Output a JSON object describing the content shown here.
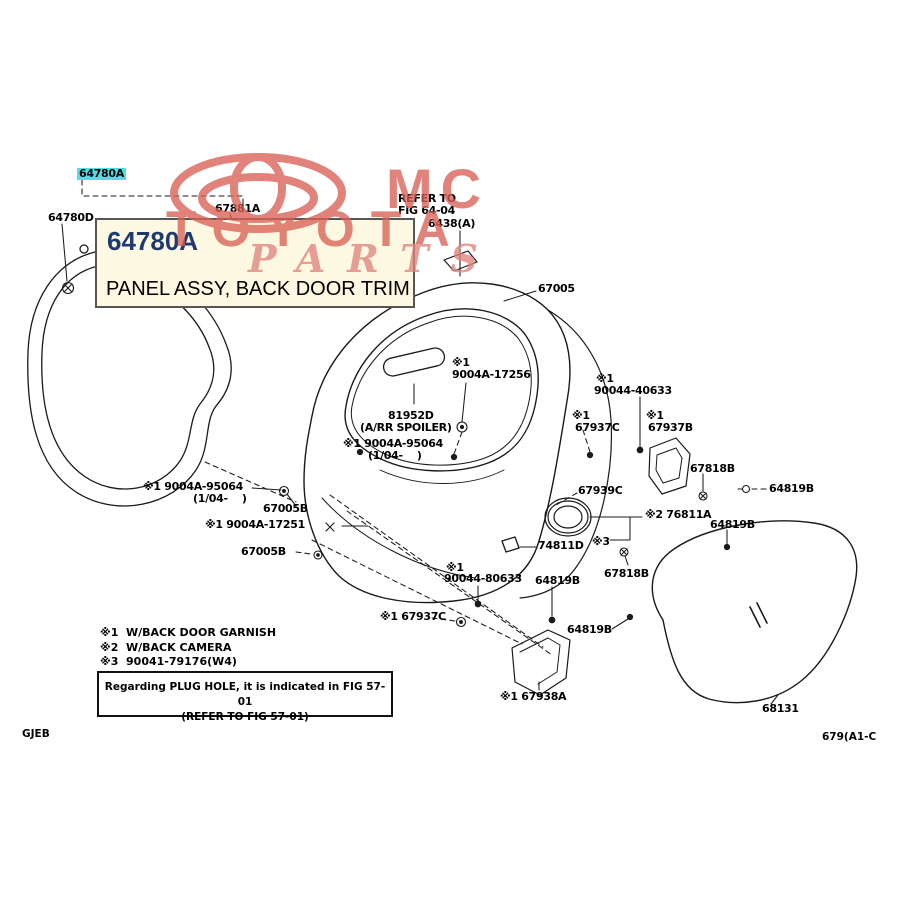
{
  "watermark": {
    "mc_text": "MC",
    "brand_text": "TOYOTA",
    "script_text": "PARTS",
    "color": "#d96156"
  },
  "callout": {
    "part_number": "64780A",
    "description": "PANEL ASSY, BACK DOOR TRIM",
    "background": "#fcf8e2",
    "number_color": "#1e3a6e"
  },
  "highlight_color": "#4fdde8",
  "diagram": {
    "labels": [
      {
        "text": "64780A",
        "x": 77,
        "y": 168,
        "hl": true
      },
      {
        "text": "64780D",
        "x": 48,
        "y": 212
      },
      {
        "text": "67881A",
        "x": 215,
        "y": 203
      },
      {
        "text": "REFER TO",
        "x": 398,
        "y": 193
      },
      {
        "text": "FIG 64-04",
        "x": 398,
        "y": 205
      },
      {
        "text": "6438(A)",
        "x": 428,
        "y": 218
      },
      {
        "text": "67005",
        "x": 538,
        "y": 283
      },
      {
        "text": "※1",
        "x": 452,
        "y": 357
      },
      {
        "text": "9004A-17256",
        "x": 452,
        "y": 369
      },
      {
        "text": "81952D",
        "x": 388,
        "y": 410
      },
      {
        "text": "(A/RR SPOILER)",
        "x": 360,
        "y": 422
      },
      {
        "text": "※1 9004A-95064",
        "x": 343,
        "y": 438
      },
      {
        "text": "(1/04-    )",
        "x": 368,
        "y": 450
      },
      {
        "text": "※1",
        "x": 596,
        "y": 373
      },
      {
        "text": "90044-40633",
        "x": 594,
        "y": 385
      },
      {
        "text": "※1",
        "x": 572,
        "y": 410
      },
      {
        "text": "67937C",
        "x": 575,
        "y": 422
      },
      {
        "text": "※1",
        "x": 646,
        "y": 410
      },
      {
        "text": "67937B",
        "x": 648,
        "y": 422
      },
      {
        "text": "67818B",
        "x": 690,
        "y": 463
      },
      {
        "text": "64819B",
        "x": 769,
        "y": 483
      },
      {
        "text": "※1 9004A-95064",
        "x": 143,
        "y": 481
      },
      {
        "text": "(1/04-    )",
        "x": 193,
        "y": 493
      },
      {
        "text": "67005B",
        "x": 263,
        "y": 503
      },
      {
        "text": "※1 9004A-17251",
        "x": 205,
        "y": 519
      },
      {
        "text": "67005B",
        "x": 241,
        "y": 546
      },
      {
        "text": "67939C",
        "x": 578,
        "y": 485
      },
      {
        "text": "※2 76811A",
        "x": 645,
        "y": 509
      },
      {
        "text": "64819B",
        "x": 710,
        "y": 519
      },
      {
        "text": "74811D",
        "x": 538,
        "y": 540
      },
      {
        "text": "※3",
        "x": 592,
        "y": 536
      },
      {
        "text": "67818B",
        "x": 604,
        "y": 568
      },
      {
        "text": "※1",
        "x": 446,
        "y": 562
      },
      {
        "text": "90044-80633",
        "x": 444,
        "y": 573
      },
      {
        "text": "64819B",
        "x": 535,
        "y": 575
      },
      {
        "text": "※1 67937C",
        "x": 380,
        "y": 611
      },
      {
        "text": "64819B",
        "x": 567,
        "y": 624
      },
      {
        "text": "※1 67938A",
        "x": 500,
        "y": 691
      },
      {
        "text": "68131",
        "x": 762,
        "y": 703
      }
    ]
  },
  "notes": {
    "lines": [
      "※1  W/BACK DOOR GARNISH",
      "※2  W/BACK CAMERA",
      "※3  90041-79176(W4)"
    ]
  },
  "plug_note": {
    "line1": "Regarding PLUG HOLE, it is indicated in FIG 57-01",
    "line2": "(REFER TO FIG 57-01)"
  },
  "footer": {
    "left_code": "GJEB",
    "right_code": "679(A1-C"
  }
}
